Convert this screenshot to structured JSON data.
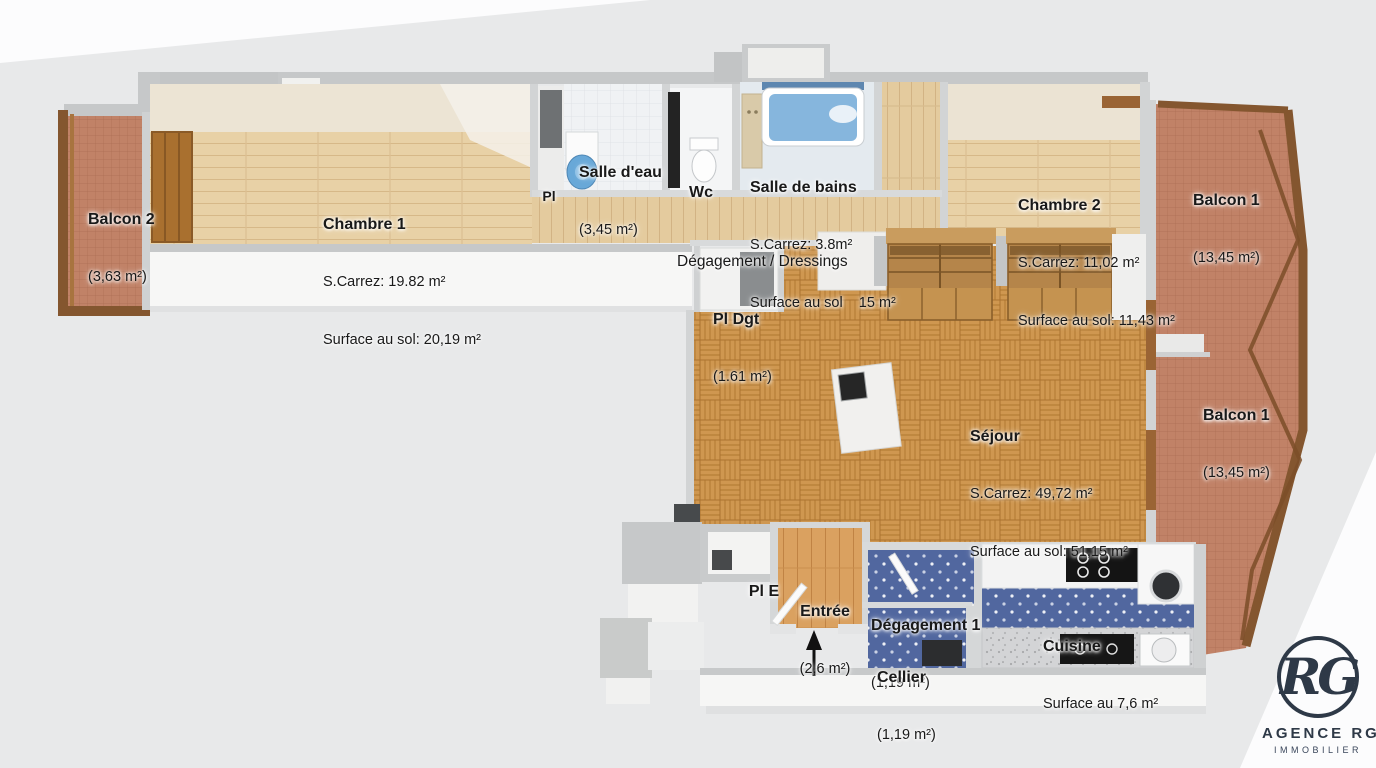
{
  "background": {
    "gray": "#e8e9ea",
    "white": "#fcfcfd"
  },
  "rooms": {
    "balcon_2": {
      "title": "Balcon 2",
      "area": "(3,63 m²)"
    },
    "chambre_1": {
      "title": "Chambre 1",
      "carrez": "S.Carrez: 19.82 m²",
      "sol": "Surface au sol: 20,19 m²"
    },
    "placard_chambre1": {
      "title": "Pl"
    },
    "salle_deau": {
      "title": "Salle d'eau",
      "area": "(3,45 m²)"
    },
    "wc": {
      "title": "Wc"
    },
    "salle_de_bains": {
      "title": "Salle de bains",
      "carrez": "S.Carrez: 3.8m²",
      "sol": "Surface au sol    15 m²"
    },
    "degagement_dressings": {
      "title": "Dégagement / Dressings"
    },
    "chambre_2": {
      "title": "Chambre 2",
      "carrez": "S.Carrez: 11,02 m²",
      "sol": "Surface au sol: 11,43 m²"
    },
    "balcon_1_haut": {
      "title": "Balcon 1",
      "area": "(13,45 m²)"
    },
    "pl_dgt": {
      "title": "Pl Dgt",
      "area": "(1.61 m²)"
    },
    "sejour": {
      "title": "Séjour",
      "carrez": "S.Carrez: 49,72 m²",
      "sol": "Surface au sol: 51,15 m²"
    },
    "balcon_1_milieu": {
      "title": "Balcon 1",
      "area": "(13,45 m²)"
    },
    "pl_e": {
      "title": "Pl E"
    },
    "entree": {
      "title": "Entrée",
      "area": "(2,6 m²)"
    },
    "degagement_1": {
      "title": "Dégagement 1",
      "area": "(1,19 m²)"
    },
    "cellier": {
      "title": "Cellier",
      "area": "(1,19 m²)"
    },
    "cuisine": {
      "title": "Cuisine",
      "sol": "Surface au 7,6 m²"
    }
  },
  "logo": {
    "monogram": "RG",
    "agency": "AGENCE RG",
    "tagline": "IMMOBILIER",
    "color": "#2e3947"
  },
  "palette": {
    "wall_top": "#c6c8c9",
    "wall_face": "#f6f6f5",
    "wood_light": "#e8d1a6",
    "parquet": "#cf9750",
    "terracotta": "#c18267",
    "kitchen_floor": "#51679f",
    "bath_blue": "#86b6dd",
    "wood_frame": "#84562f"
  }
}
